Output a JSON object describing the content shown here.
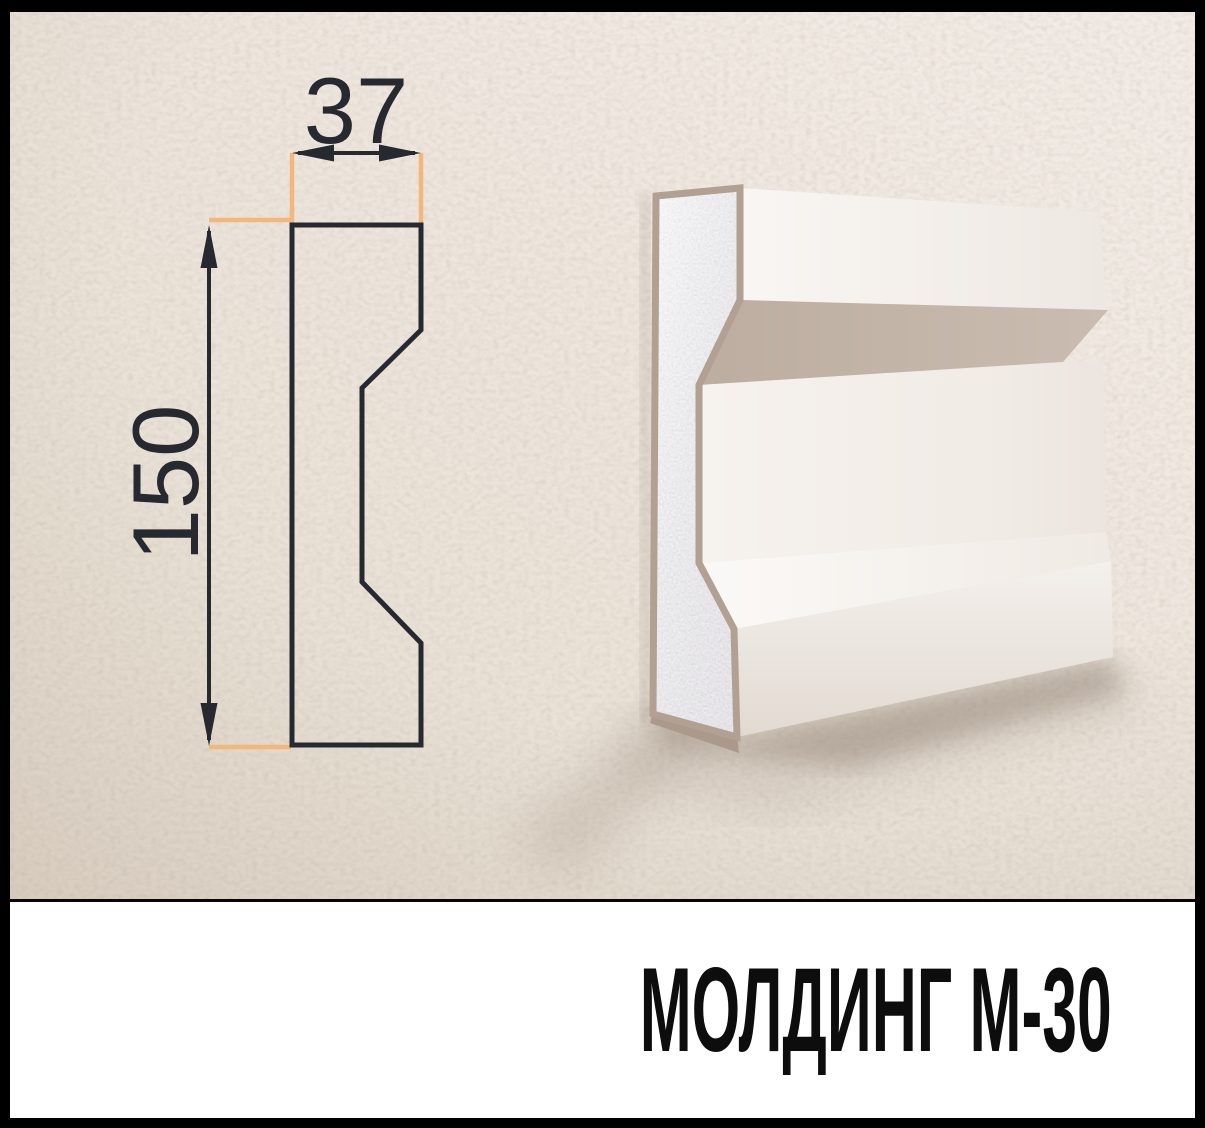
{
  "caption": {
    "text": "МОЛДИНГ М-30"
  },
  "drawing": {
    "type": "cross-section-profile",
    "width_label": "37",
    "height_label": "150"
  },
  "render": {
    "subject": "wall-mounted molding, 3d three-quarter view, foam core with coated front"
  },
  "colors": {
    "frame": "#000000",
    "wall_dark": "#e7ddd1",
    "wall_mid": "#eee6dc",
    "wall_light": "#f3ece6",
    "line_dark": "#262a30",
    "dim_orange": "#f3b77c",
    "coating_tan": "#b2a093",
    "underside_tan": "#c2b3a7",
    "foam_base": "#e6e4e8",
    "face_white": "#f7f4f1",
    "caption_bg": "#ffffff",
    "caption_color": "#0d0d0d"
  }
}
